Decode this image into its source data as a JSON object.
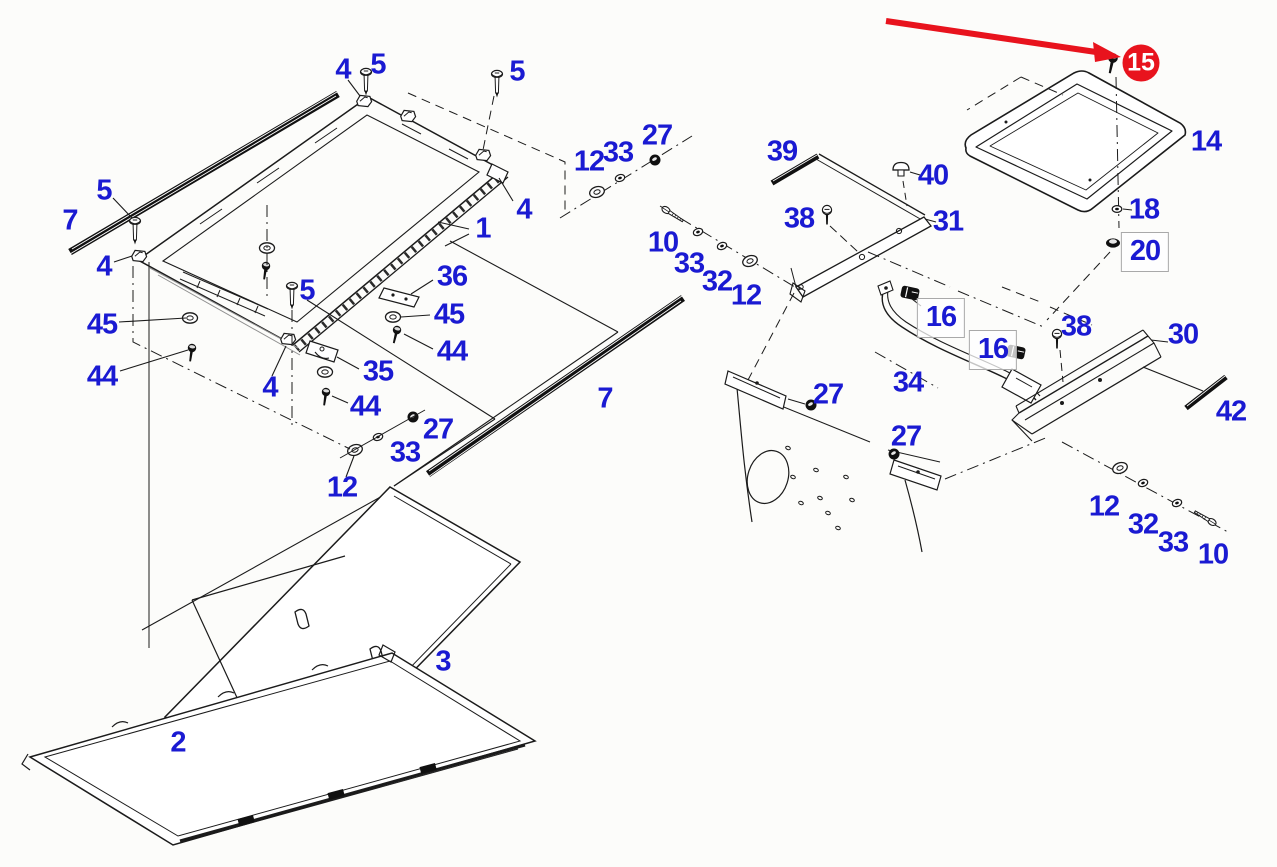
{
  "diagram": {
    "title": "roof-assembly-exploded-parts-diagram",
    "colors": {
      "background": "#fcfcfa",
      "label": "#1a1ad2",
      "line": "#1b1b1b",
      "highlight": "#e8131d",
      "box_border": "#a9a9a9"
    },
    "highlighted_part": "15",
    "labels": [
      {
        "text": "4",
        "x": 343,
        "y": 70
      },
      {
        "text": "5",
        "x": 378,
        "y": 65
      },
      {
        "text": "5",
        "x": 517,
        "y": 72
      },
      {
        "text": "27",
        "x": 657,
        "y": 136
      },
      {
        "text": "33",
        "x": 618,
        "y": 153
      },
      {
        "text": "12",
        "x": 589,
        "y": 162
      },
      {
        "text": "5",
        "x": 104,
        "y": 191
      },
      {
        "text": "7",
        "x": 70,
        "y": 221
      },
      {
        "text": "4",
        "x": 104,
        "y": 267
      },
      {
        "text": "4",
        "x": 524,
        "y": 210
      },
      {
        "text": "1",
        "x": 483,
        "y": 229
      },
      {
        "text": "36",
        "x": 452,
        "y": 277
      },
      {
        "text": "5",
        "x": 307,
        "y": 291
      },
      {
        "text": "45",
        "x": 102,
        "y": 325
      },
      {
        "text": "45",
        "x": 449,
        "y": 315
      },
      {
        "text": "44",
        "x": 452,
        "y": 352
      },
      {
        "text": "44",
        "x": 102,
        "y": 377
      },
      {
        "text": "35",
        "x": 378,
        "y": 372
      },
      {
        "text": "4",
        "x": 270,
        "y": 388
      },
      {
        "text": "44",
        "x": 365,
        "y": 407
      },
      {
        "text": "7",
        "x": 605,
        "y": 399
      },
      {
        "text": "27",
        "x": 438,
        "y": 430
      },
      {
        "text": "33",
        "x": 405,
        "y": 453
      },
      {
        "text": "12",
        "x": 342,
        "y": 488
      },
      {
        "text": "3",
        "x": 443,
        "y": 662
      },
      {
        "text": "2",
        "x": 178,
        "y": 743
      },
      {
        "text": "39",
        "x": 782,
        "y": 152
      },
      {
        "text": "40",
        "x": 933,
        "y": 176
      },
      {
        "text": "38",
        "x": 799,
        "y": 219
      },
      {
        "text": "31",
        "x": 948,
        "y": 222
      },
      {
        "text": "10",
        "x": 663,
        "y": 243
      },
      {
        "text": "33",
        "x": 689,
        "y": 264
      },
      {
        "text": "32",
        "x": 717,
        "y": 282
      },
      {
        "text": "12",
        "x": 746,
        "y": 296
      },
      {
        "text": "16",
        "x": 941,
        "y": 318,
        "style": "boxed"
      },
      {
        "text": "16",
        "x": 993,
        "y": 350,
        "style": "boxed"
      },
      {
        "text": "38",
        "x": 1076,
        "y": 327
      },
      {
        "text": "30",
        "x": 1183,
        "y": 335
      },
      {
        "text": "42",
        "x": 1231,
        "y": 412
      },
      {
        "text": "34",
        "x": 908,
        "y": 383
      },
      {
        "text": "27",
        "x": 828,
        "y": 395
      },
      {
        "text": "27",
        "x": 906,
        "y": 437
      },
      {
        "text": "14",
        "x": 1206,
        "y": 142
      },
      {
        "text": "15",
        "x": 1141,
        "y": 63,
        "style": "circled"
      },
      {
        "text": "18",
        "x": 1144,
        "y": 210
      },
      {
        "text": "20",
        "x": 1145,
        "y": 252,
        "style": "boxed"
      },
      {
        "text": "12",
        "x": 1104,
        "y": 507
      },
      {
        "text": "32",
        "x": 1143,
        "y": 525
      },
      {
        "text": "33",
        "x": 1173,
        "y": 543
      },
      {
        "text": "10",
        "x": 1213,
        "y": 555
      }
    ]
  }
}
